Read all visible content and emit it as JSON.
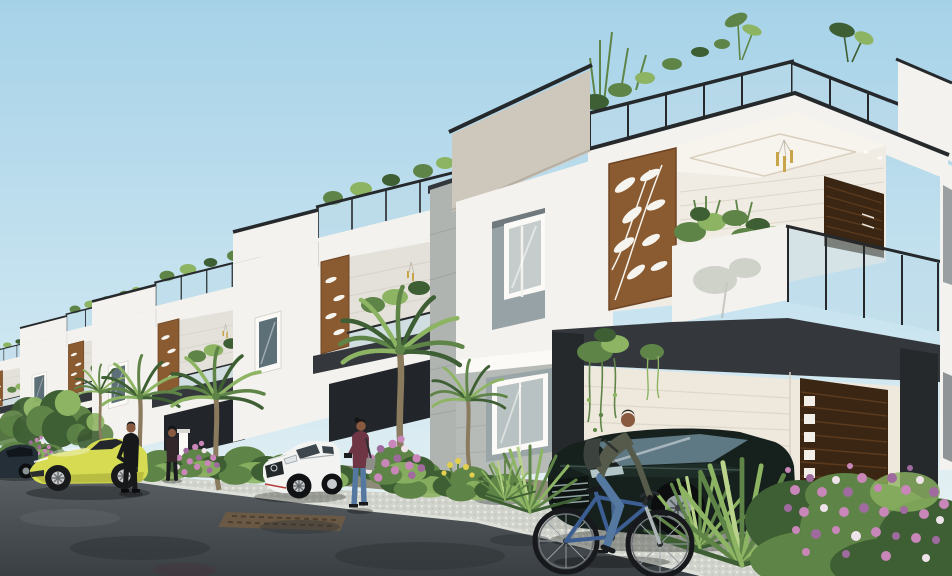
{
  "scene": {
    "title": "Street view of a row of modern white duplex villas — 3D architectural render",
    "type": "3d-architectural-render",
    "time_of_day": "bright daylight, clear pale-blue sky",
    "description": "A receding row of five modern G+1 villas with black-trimmed parapets, rooftop glass railings with plants, laser-cut wooden fern panels on balconies, carports with dark wood doors; street in front with a yellow sports car, a white sedan, a dark sedan, a parked car in the carport, two men in suits, a woman with a phone, and a man riding a blue bicycle; palms and pink flower bushes line the footpath."
  },
  "inventory": {
    "villa_count": 5,
    "vehicles": [
      {
        "name": "sports-car-yellow",
        "description": "yellow-green sports car parked on the road, nose left"
      },
      {
        "name": "sedan-white",
        "description": "white luxury sedan parked on the driveway apron"
      },
      {
        "name": "sedan-carport",
        "description": "dark green sedan parked under the main villa carport"
      },
      {
        "name": "car-far-left",
        "description": "dark car partially visible at the far left"
      }
    ],
    "people": [
      {
        "name": "man-in-suit",
        "description": "man in a black suit standing beside the yellow sports car"
      },
      {
        "name": "man-at-gate",
        "description": "second man standing near the compound entrance"
      },
      {
        "name": "woman-with-phone",
        "description": "woman in maroon top and jeans looking at her phone"
      },
      {
        "name": "cyclist",
        "description": "man with backpack riding a blue bicycle to the right"
      }
    ],
    "architecture": [
      "rooftop-glass-railing",
      "parapet-coping",
      "laser-cut-fern-panel",
      "balcony-glass-railing",
      "pendant-light",
      "carport",
      "main-door-dark-wood",
      "recessed-window",
      "garage-opening"
    ],
    "vegetation": [
      "palm-tree",
      "yucca-plant",
      "pink-flower-bush",
      "yellow-flowers",
      "rooftop-plants",
      "hanging-vines",
      "balcony-plants",
      "leafy-tree",
      "hedge-bushes"
    ]
  },
  "palette": {
    "sky_top": "#a6d2e8",
    "sky_mid": "#c9e4f0",
    "sky_horizon": "#eef5f4",
    "wall_white": "#f4f2ee",
    "wall_bright": "#fbfaf7",
    "wall_shadow": "#e4e1da",
    "wall_gray": "#b7bbb7",
    "parapet_beige": "#cec7bb",
    "charcoal": "#34383c",
    "charcoal_dark": "#26292c",
    "glass": "#bcd9e8",
    "wood_brown": "#8a5a30",
    "door_dark": "#3a2613",
    "leaf_dark": "#3e5e33",
    "leaf_mid": "#5f8447",
    "leaf_light": "#8db463",
    "leaf_pale": "#b9d48a",
    "trunk": "#8a7a5e",
    "flower_pink": "#c887b8",
    "flower_violet": "#9f6b9e",
    "flower_white": "#efe3ea",
    "flower_yellow": "#e3cf4e",
    "car_yellow": "#d6db52",
    "car_yellow_dark": "#aeb33c",
    "car_white": "#f3f4f2",
    "car_dark": "#16211e",
    "car_navy": "#242f38",
    "bike_blue": "#3c5e92",
    "road": "#3a3f43",
    "road_light": "#5a6064",
    "paver": "#d0d3cb",
    "paver_dot": "#e6e8e1",
    "curb": "#dee1d9",
    "paver_brown": "#6e5a44",
    "soil": "#8e8c78",
    "skin": "#8a5a40",
    "denim": "#5578a0",
    "jacket": "#565a4a",
    "suit_black": "#17181a",
    "maroon": "#6e3644",
    "metal": "#c9ccce",
    "gold": "#c9a54a"
  }
}
